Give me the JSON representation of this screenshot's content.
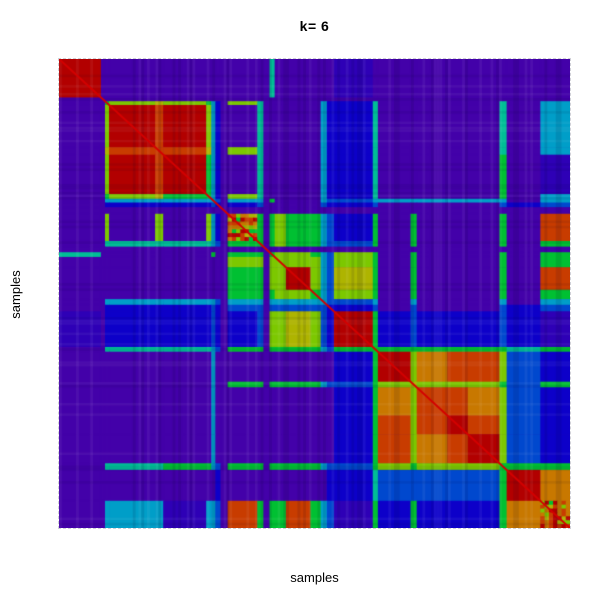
{
  "chart_data": {
    "type": "heatmap",
    "title": "k= 6",
    "xlabel": "samples",
    "ylabel": "samples",
    "description": "Consensus clustering matrix heatmap for k=6; symmetric sample-by-sample consensus values from low (violet) to high (dark red), with cluster blocks along the diagonal",
    "legend": "none",
    "grid": "off",
    "axis_ticks": "none",
    "palette": {
      "P": "#4301A9",
      "Q": "#2E00B6",
      "B": "#0D00C9",
      "b": "#0048CE",
      "C": "#009EC8",
      "T": "#00BE96",
      "G": "#00C032",
      "g": "#7CC800",
      "Y": "#AEB400",
      "O": "#C87800",
      "o": "#C83C00",
      "R": "#B20000"
    },
    "segment_boundaries": [
      0,
      0.082,
      0.09,
      0.098,
      0.188,
      0.204,
      0.288,
      0.298,
      0.306,
      0.316,
      0.33,
      0.388,
      0.4,
      0.412,
      0.422,
      0.444,
      0.492,
      0.512,
      0.524,
      0.538,
      0.614,
      0.624,
      0.688,
      0.7,
      0.76,
      0.8,
      0.862,
      0.876,
      0.942,
      1.0
    ],
    "matrix_upper_rows": [
      "RPPPPPPPPPPPPTPPPPPQPPPPPPPPP",
      "PPPPPPPPPPPPPPPPPPPPPPPPPPPP",
      "GgYgGCBPgTPPPPPCBBTPPPPPTPC",
      "RoRgCBPPTPPPPPCBBTPPPPPTPC",
      "ooYCBPgTPPPPPCBBTPPPPPTPC",
      "RGCBPPTPPPPPCBBTPPPPPGPQ",
      "GCBPgTPPPPPCBBTPPPPPGPC",
      "CbPCCPGPPPCbbCCCCCCCPC",
      "BPBbPPPPPbBBbPPPPPbBb",
      "PPPPPPPPPPPPPPPPPPPP",
      "OGPGgGGCbBGPGPPPGPo",
      "GPGgGGCbbGPGPPPGPG",
      "PPPPPPPPPPPPPPPPP",
      "GggGCbgGPGPPPGPG",
      "gggCbgGPGPPPGPG",
      "RgCbYGPGPPPGPo",
      "GCbgGPGPPPGPG",
      "CbbCPCPPPCPC",
      "BBbPbPPPbBb",
      "RGBbBBBbBQ",
      "GGGGGGGTG",
      "RgOoogbB",
      "YgggGbG",
      "ooOgbB",
      "RogbB",
      "RgbB",
      "GGG",
      "RO",
      "O"
    ],
    "fuzzy_diag_segments": [
      10,
      28
    ],
    "fuzzy_texture_letters": "OogYRGoRO",
    "diagonal_line_color": "#D40000",
    "background_color": "#4301A9",
    "n_sample_stripes": 180,
    "plot_area": {
      "left": 59,
      "top": 59,
      "width": 511,
      "height": 469
    }
  }
}
